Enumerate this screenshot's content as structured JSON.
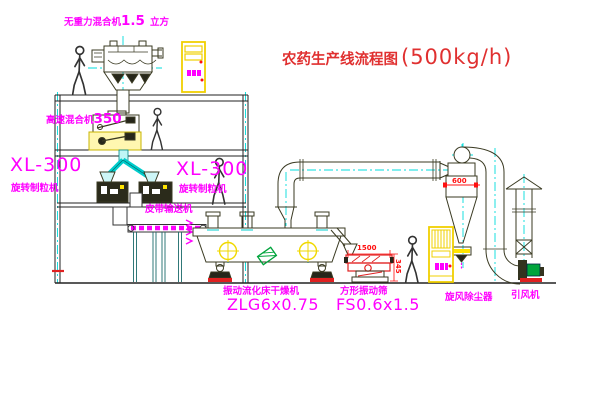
{
  "title": {
    "text": "农药生产线流程图",
    "capacity": "(500kg/h)"
  },
  "labels": {
    "gravity_mixer": {
      "prefix": "无重力混合机",
      "size": "1.5",
      "suffix": "立方"
    },
    "high_speed_mixer": {
      "prefix": "高速混合机",
      "size": "350"
    },
    "granulator_left": {
      "model": "XL-300",
      "name": "旋转制粒机"
    },
    "granulator_right": {
      "model": "XL-300",
      "name": "旋转制粒机"
    },
    "belt_conveyor": "皮带输送机",
    "dryer": {
      "name": "振动流化床干燥机",
      "model": "ZLG6x0.75"
    },
    "screen": {
      "name": "方形振动筛",
      "model": "FS0.6x1.5"
    },
    "cyclone": "旋风除尘器",
    "fan": "引风机"
  },
  "dimensions": {
    "screen_width": "1500",
    "screen_height": "345",
    "cyclone_width": "600"
  },
  "colors": {
    "label_magenta": "#ff00ff",
    "title_red": "#e03030",
    "dimension_red": "#ff1010",
    "centerline_cyan": "#00dcdc",
    "highlight_yellow": "#ffe400",
    "machine_line": "#3a3a22",
    "motor_green": "#00a43c"
  }
}
